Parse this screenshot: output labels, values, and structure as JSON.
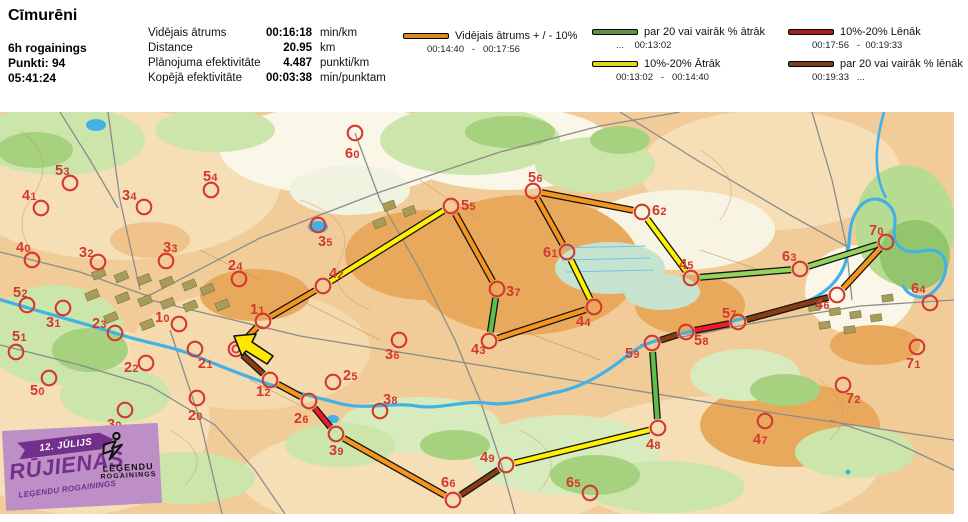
{
  "header": {
    "title": "Cīmurēni",
    "meta": [
      "6h rogainings",
      "Punkti: 94",
      "05:41:24"
    ],
    "stats": [
      {
        "label": "Vidējais ātrums",
        "value": "00:16:18",
        "unit": "min/km"
      },
      {
        "label": "Distance",
        "value": "20.95",
        "unit": "km"
      },
      {
        "label": "Plānojuma efektivitāte",
        "value": "4.487",
        "unit": "punkti/km"
      },
      {
        "label": "Kopējā efektivitāte",
        "value": "00:03:38",
        "unit": "min/punktam"
      }
    ],
    "legend": [
      {
        "color": "#DB8A1E",
        "label": "Vidējais ātrums + / - 10%",
        "range": "00:14:40   -   00:17:56"
      },
      {
        "color": "#5E9140",
        "label": "par 20 vai vairāk % ātrāk",
        "range": "...    00:13:02"
      },
      {
        "color": "#DFD622",
        "label": "10%-20% Ātrāk",
        "range": "00:13:02   -   00:14:40"
      },
      {
        "color": "#A81D1D",
        "label": "10%-20% Lēnāk",
        "range": "00:17:56   -  00:19:33"
      },
      {
        "color": "#7A3D22",
        "label": "par 20 vai vairāk % lēnāk",
        "range": "00:19:33   ..."
      }
    ]
  },
  "map": {
    "palette": {
      "orange": "#F7941D",
      "yellow": "#FFF100",
      "green": "#5DBE49",
      "lightgreen": "#95D45C",
      "red": "#EC1C24",
      "brown": "#8A3D11",
      "control": "#D4382E",
      "start_arrow": "#FFE800",
      "outline": "#151515"
    },
    "start": {
      "x": 236,
      "y": 349
    },
    "controls": [
      {
        "id": "10",
        "x": 179,
        "y": 324,
        "lx": 155,
        "ly": 322,
        "visited": false
      },
      {
        "id": "11",
        "x": 263,
        "y": 321,
        "lx": 250,
        "ly": 314,
        "visited": true
      },
      {
        "id": "12",
        "x": 270,
        "y": 380,
        "lx": 256,
        "ly": 396,
        "visited": true
      },
      {
        "id": "20",
        "x": 197,
        "y": 398,
        "lx": 188,
        "ly": 420,
        "visited": false
      },
      {
        "id": "21",
        "x": 195,
        "y": 349,
        "lx": 198,
        "ly": 368,
        "visited": false
      },
      {
        "id": "22",
        "x": 146,
        "y": 363,
        "lx": 124,
        "ly": 372,
        "visited": false
      },
      {
        "id": "23",
        "x": 115,
        "y": 333,
        "lx": 92,
        "ly": 328,
        "visited": false
      },
      {
        "id": "24",
        "x": 239,
        "y": 279,
        "lx": 228,
        "ly": 270,
        "visited": false
      },
      {
        "id": "25",
        "x": 333,
        "y": 382,
        "lx": 343,
        "ly": 380,
        "visited": false
      },
      {
        "id": "26",
        "x": 309,
        "y": 401,
        "lx": 294,
        "ly": 423,
        "visited": true
      },
      {
        "id": "30",
        "x": 125,
        "y": 410,
        "lx": 107,
        "ly": 429,
        "visited": false
      },
      {
        "id": "31",
        "x": 63,
        "y": 308,
        "lx": 46,
        "ly": 327,
        "visited": false
      },
      {
        "id": "32",
        "x": 98,
        "y": 262,
        "lx": 79,
        "ly": 257,
        "visited": false
      },
      {
        "id": "33",
        "x": 166,
        "y": 261,
        "lx": 163,
        "ly": 252,
        "visited": false
      },
      {
        "id": "34",
        "x": 144,
        "y": 207,
        "lx": 122,
        "ly": 200,
        "visited": false
      },
      {
        "id": "35",
        "x": 318,
        "y": 225,
        "lx": 318,
        "ly": 246,
        "visited": false
      },
      {
        "id": "36",
        "x": 399,
        "y": 340,
        "lx": 385,
        "ly": 359,
        "visited": false
      },
      {
        "id": "37",
        "x": 497,
        "y": 289,
        "lx": 506,
        "ly": 296,
        "visited": true
      },
      {
        "id": "38",
        "x": 380,
        "y": 411,
        "lx": 383,
        "ly": 404,
        "visited": false
      },
      {
        "id": "39",
        "x": 336,
        "y": 434,
        "lx": 329,
        "ly": 455,
        "visited": true
      },
      {
        "id": "40",
        "x": 32,
        "y": 260,
        "lx": 16,
        "ly": 252,
        "visited": false
      },
      {
        "id": "41",
        "x": 41,
        "y": 208,
        "lx": 22,
        "ly": 200,
        "visited": false
      },
      {
        "id": "42",
        "x": 323,
        "y": 286,
        "lx": 329,
        "ly": 278,
        "visited": true
      },
      {
        "id": "43",
        "x": 489,
        "y": 341,
        "lx": 471,
        "ly": 354,
        "visited": true
      },
      {
        "id": "44",
        "x": 594,
        "y": 307,
        "lx": 576,
        "ly": 326,
        "visited": true
      },
      {
        "id": "45",
        "x": 691,
        "y": 278,
        "lx": 679,
        "ly": 269,
        "visited": true
      },
      {
        "id": "46",
        "x": 837,
        "y": 295,
        "lx": 815,
        "ly": 309,
        "visited": true
      },
      {
        "id": "47",
        "x": 765,
        "y": 421,
        "lx": 753,
        "ly": 444,
        "visited": false
      },
      {
        "id": "48",
        "x": 658,
        "y": 428,
        "lx": 646,
        "ly": 449,
        "visited": true
      },
      {
        "id": "49",
        "x": 506,
        "y": 465,
        "lx": 480,
        "ly": 462,
        "visited": true
      },
      {
        "id": "50",
        "x": 49,
        "y": 378,
        "lx": 30,
        "ly": 395,
        "visited": false
      },
      {
        "id": "51",
        "x": 16,
        "y": 352,
        "lx": 12,
        "ly": 341,
        "visited": false
      },
      {
        "id": "52",
        "x": 27,
        "y": 305,
        "lx": 13,
        "ly": 297,
        "visited": false
      },
      {
        "id": "53",
        "x": 70,
        "y": 183,
        "lx": 55,
        "ly": 175,
        "visited": false
      },
      {
        "id": "54",
        "x": 211,
        "y": 190,
        "lx": 203,
        "ly": 181,
        "visited": false
      },
      {
        "id": "55",
        "x": 451,
        "y": 206,
        "lx": 461,
        "ly": 210,
        "visited": true
      },
      {
        "id": "56",
        "x": 533,
        "y": 191,
        "lx": 528,
        "ly": 182,
        "visited": true
      },
      {
        "id": "57",
        "x": 738,
        "y": 322,
        "lx": 722,
        "ly": 318,
        "visited": true
      },
      {
        "id": "58",
        "x": 686,
        "y": 332,
        "lx": 694,
        "ly": 345,
        "visited": true
      },
      {
        "id": "59",
        "x": 652,
        "y": 343,
        "lx": 625,
        "ly": 358,
        "visited": true
      },
      {
        "id": "60",
        "x": 355,
        "y": 133,
        "lx": 345,
        "ly": 158,
        "visited": false
      },
      {
        "id": "61",
        "x": 567,
        "y": 252,
        "lx": 543,
        "ly": 257,
        "visited": true
      },
      {
        "id": "62",
        "x": 642,
        "y": 212,
        "lx": 652,
        "ly": 215,
        "visited": true
      },
      {
        "id": "63",
        "x": 800,
        "y": 269,
        "lx": 782,
        "ly": 261,
        "visited": true
      },
      {
        "id": "64",
        "x": 930,
        "y": 303,
        "lx": 911,
        "ly": 293,
        "visited": false
      },
      {
        "id": "65",
        "x": 590,
        "y": 493,
        "lx": 566,
        "ly": 487,
        "visited": false
      },
      {
        "id": "66",
        "x": 453,
        "y": 500,
        "lx": 441,
        "ly": 487,
        "visited": true
      },
      {
        "id": "70",
        "x": 886,
        "y": 242,
        "lx": 869,
        "ly": 235,
        "visited": true
      },
      {
        "id": "71",
        "x": 917,
        "y": 347,
        "lx": 906,
        "ly": 368,
        "visited": false
      },
      {
        "id": "72",
        "x": 843,
        "y": 385,
        "lx": 846,
        "ly": 403,
        "visited": false
      }
    ],
    "legs": [
      {
        "from": "S",
        "to": "11",
        "color": "orange"
      },
      {
        "from": "11",
        "to": "42",
        "color": "orange"
      },
      {
        "from": "42",
        "to": "55",
        "color": "yellow"
      },
      {
        "from": "55",
        "to": "37",
        "color": "orange"
      },
      {
        "from": "37",
        "to": "43",
        "color": "green"
      },
      {
        "from": "43",
        "to": "44",
        "color": "orange"
      },
      {
        "from": "44",
        "to": "61",
        "color": "yellow"
      },
      {
        "from": "61",
        "to": "56",
        "color": "orange"
      },
      {
        "from": "56",
        "to": "62",
        "color": "orange"
      },
      {
        "from": "62",
        "to": "45",
        "color": "yellow"
      },
      {
        "from": "45",
        "to": "63",
        "color": "lightgreen"
      },
      {
        "from": "63",
        "to": "70",
        "color": "lightgreen"
      },
      {
        "from": "70",
        "to": "46",
        "color": "orange"
      },
      {
        "from": "46",
        "to": "57",
        "color": "brown"
      },
      {
        "from": "57",
        "to": "58",
        "color": "red"
      },
      {
        "from": "58",
        "to": "59",
        "color": "brown"
      },
      {
        "from": "59",
        "to": "48",
        "color": "green"
      },
      {
        "from": "48",
        "to": "49",
        "color": "yellow"
      },
      {
        "from": "49",
        "to": "66",
        "color": "brown"
      },
      {
        "from": "66",
        "to": "39",
        "color": "orange"
      },
      {
        "from": "39",
        "to": "26",
        "color": "red"
      },
      {
        "from": "26",
        "to": "12",
        "color": "orange"
      },
      {
        "from": "12",
        "to": "S",
        "color": "brown"
      }
    ]
  },
  "banner": {
    "date": "12. JŪLIJS",
    "title": "RŪJIENAS",
    "subtitle": "LEĢENDU ROGAININGS",
    "logo_line1": "LEĢENDU",
    "logo_line2": "ROGAININGS"
  }
}
